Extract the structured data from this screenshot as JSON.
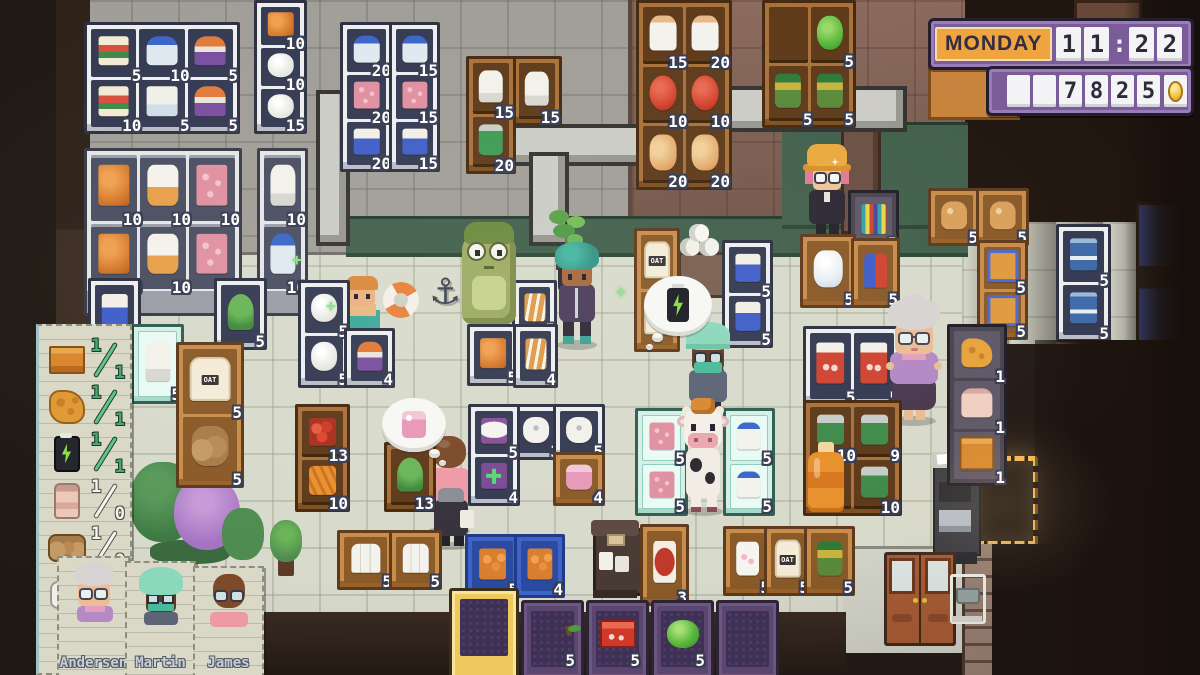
{
  "hud": {
    "day": "MONDAY",
    "time": "11:22",
    "money": "7825",
    "money_lead_blanks": 2,
    "colors": {
      "panel_purple": "#7a5c98",
      "day_orange": "#f0a440",
      "cell_white": "#f4f4f6",
      "coin_gold": "#f2c23c",
      "count_text": "#ffffff",
      "checklist_done_green": "#46a872",
      "hotbar_selected_gold": "#f0c95e"
    }
  },
  "checklist": {
    "items": [
      {
        "icon": "crate-icon",
        "have": "1",
        "need": "1",
        "done": true
      },
      {
        "icon": "cheese-icon",
        "have": "1",
        "need": "1",
        "done": true
      },
      {
        "icon": "battery-icon",
        "have": "1",
        "need": "1",
        "done": true
      },
      {
        "icon": "bottle-icon",
        "have": "1",
        "need": "0",
        "done": false
      },
      {
        "icon": "sack-icon",
        "have": "1",
        "need": "0",
        "done": false
      },
      {
        "icon": "paper-roll-icon",
        "have": "1",
        "need": "0",
        "done": false
      }
    ]
  },
  "staff_cards": [
    {
      "name": "Andersen"
    },
    {
      "name": "Martin"
    },
    {
      "name": "James"
    }
  ],
  "hotbar": {
    "slots": [
      {
        "item": "none",
        "count": "",
        "selected": true
      },
      {
        "item": "apple",
        "count": "5",
        "selected": false
      },
      {
        "item": "red-box",
        "count": "5",
        "selected": false
      },
      {
        "item": "lettuce",
        "count": "5",
        "selected": false
      },
      {
        "item": "none",
        "count": "",
        "selected": false
      }
    ]
  },
  "thought_bubbles": [
    {
      "id": "thought-bubble-battery",
      "icon": "battery-icon"
    },
    {
      "id": "thought-bubble-soap",
      "icon": "soap-icon"
    }
  ],
  "shelves": [
    {
      "id": "freezer-snacks-grid",
      "style": "frz",
      "x": 84,
      "y": 22,
      "w": 150,
      "h": 106,
      "cols": 3,
      "cells": [
        {
          "item": "snackbox",
          "count": "5"
        },
        {
          "item": "water",
          "count": "10"
        },
        {
          "item": "icepop",
          "count": "5"
        },
        {
          "item": "snackbox",
          "count": "10"
        },
        {
          "item": "milkcarton",
          "count": "5"
        },
        {
          "item": "icepop",
          "count": "5"
        }
      ]
    },
    {
      "id": "freezer-column-left",
      "style": "frz",
      "x": 254,
      "y": 0,
      "w": 47,
      "h": 128,
      "cols": 1,
      "cells": [
        {
          "item": "orangefood",
          "count": "10"
        },
        {
          "item": "chicken",
          "count": "10"
        },
        {
          "item": "chicken",
          "count": "15"
        }
      ]
    },
    {
      "id": "glass-freezer-triple",
      "style": "glass",
      "x": 84,
      "y": 148,
      "w": 152,
      "h": 162,
      "cols": 3,
      "cells": [
        {
          "item": "orangefood",
          "count": "10"
        },
        {
          "item": "breadbag",
          "count": "10"
        },
        {
          "item": "meatpink",
          "count": "10"
        },
        {
          "item": "orangefood",
          "count": "10"
        },
        {
          "item": "breadbag",
          "count": "10"
        },
        {
          "item": "meatpink",
          "count": "10"
        }
      ]
    },
    {
      "id": "glass-freezer-single",
      "style": "glass",
      "x": 257,
      "y": 148,
      "w": 45,
      "h": 162,
      "cols": 1,
      "cells": [
        {
          "item": "ricebag",
          "count": "10"
        },
        {
          "item": "water",
          "count": "10"
        }
      ]
    },
    {
      "id": "freezer-column-mid-1",
      "style": "frz",
      "x": 340,
      "y": 22,
      "w": 47,
      "h": 144,
      "cols": 1,
      "cells": [
        {
          "item": "water",
          "count": "20"
        },
        {
          "item": "meatpink",
          "count": "20"
        },
        {
          "item": "friesbox",
          "count": "20"
        }
      ]
    },
    {
      "id": "freezer-column-mid-2",
      "style": "frz",
      "x": 389,
      "y": 22,
      "w": 45,
      "h": 144,
      "cols": 1,
      "cells": [
        {
          "item": "water",
          "count": "15"
        },
        {
          "item": "meatpink",
          "count": "15"
        },
        {
          "item": "friesbox",
          "count": "15"
        }
      ]
    },
    {
      "id": "backroom-shelf-rice",
      "style": "wood",
      "x": 466,
      "y": 56,
      "w": 44,
      "h": 112,
      "cols": 1,
      "cells": [
        {
          "item": "ricebag",
          "count": "15"
        },
        {
          "item": "greencan",
          "count": "20"
        }
      ]
    },
    {
      "id": "backroom-shelf-rice-2",
      "style": "wood",
      "x": 512,
      "y": 56,
      "w": 44,
      "h": 64,
      "cols": 1,
      "cells": [
        {
          "item": "ricebag",
          "count": "15"
        }
      ]
    },
    {
      "id": "grocery-shelf-dairy",
      "style": "wood",
      "x": 636,
      "y": 0,
      "w": 90,
      "h": 184,
      "cols": 2,
      "cells": [
        {
          "item": "milkbottle",
          "count": "15"
        },
        {
          "item": "milkbottle",
          "count": "20"
        },
        {
          "item": "tomato",
          "count": "10"
        },
        {
          "item": "tomato",
          "count": "10"
        },
        {
          "item": "bun",
          "count": "20"
        },
        {
          "item": "bun",
          "count": "20"
        }
      ]
    },
    {
      "id": "grocery-shelf-veg",
      "style": "wood",
      "x": 762,
      "y": 0,
      "w": 88,
      "h": 122,
      "cols": 2,
      "cells": [
        {
          "item": "empty",
          "count": ""
        },
        {
          "item": "lettuce",
          "count": "5"
        },
        {
          "item": "pickles",
          "count": "5"
        },
        {
          "item": "pickles",
          "count": "5"
        }
      ]
    },
    {
      "id": "freezer-fries",
      "style": "frz",
      "x": 88,
      "y": 278,
      "w": 47,
      "h": 66,
      "cols": 1,
      "cells": [
        {
          "item": "friesbox",
          "count": "5"
        }
      ]
    },
    {
      "id": "fridge-small",
      "style": "mint",
      "x": 131,
      "y": 324,
      "w": 47,
      "h": 74,
      "cols": 1,
      "cells": [
        {
          "item": "ricebag",
          "count": "5"
        }
      ]
    },
    {
      "id": "oat-stand",
      "style": "stand",
      "x": 176,
      "y": 342,
      "w": 62,
      "h": 140,
      "cols": 1,
      "cells": [
        {
          "item": "oatbag",
          "count": "5",
          "label": "OAT"
        },
        {
          "item": "sack",
          "count": "5"
        }
      ]
    },
    {
      "id": "plant-display",
      "style": "frz",
      "x": 214,
      "y": 278,
      "w": 47,
      "h": 66,
      "cols": 1,
      "cells": [
        {
          "item": "plant",
          "count": "5"
        }
      ]
    },
    {
      "id": "freezer-chicken",
      "style": "frz",
      "x": 298,
      "y": 280,
      "w": 46,
      "h": 102,
      "cols": 1,
      "cells": [
        {
          "item": "chicken",
          "count": "5"
        },
        {
          "item": "chicken",
          "count": "5"
        }
      ]
    },
    {
      "id": "freezer-icepop",
      "style": "frz",
      "x": 344,
      "y": 328,
      "w": 45,
      "h": 54,
      "cols": 1,
      "cells": [
        {
          "item": "icepop",
          "count": "4"
        }
      ]
    },
    {
      "id": "fridge-croissant-1",
      "style": "frz",
      "x": 512,
      "y": 280,
      "w": 39,
      "h": 52,
      "cols": 1,
      "cells": [
        {
          "item": "croissant",
          "count": "5"
        }
      ]
    },
    {
      "id": "fridge-snack-orange",
      "style": "frz",
      "x": 467,
      "y": 324,
      "w": 46,
      "h": 56,
      "cols": 1,
      "cells": [
        {
          "item": "orangefood",
          "count": "5"
        }
      ]
    },
    {
      "id": "fridge-croissant-2",
      "style": "frz",
      "x": 513,
      "y": 324,
      "w": 39,
      "h": 58,
      "cols": 1,
      "cells": [
        {
          "item": "croissant",
          "count": "4"
        }
      ]
    },
    {
      "id": "shelf-oat-column",
      "style": "stand",
      "x": 634,
      "y": 228,
      "w": 40,
      "h": 118,
      "cols": 1,
      "cells": [
        {
          "item": "oatbag",
          "count": "5",
          "label": "OAT"
        },
        {
          "item": "oatbag",
          "count": "",
          "label": "OAT"
        }
      ]
    },
    {
      "id": "freezer-fries-column",
      "style": "frz",
      "x": 722,
      "y": 240,
      "w": 45,
      "h": 102,
      "cols": 1,
      "cells": [
        {
          "item": "friesbox",
          "count": "5"
        },
        {
          "item": "friesbox",
          "count": "5"
        }
      ]
    },
    {
      "id": "counter-water",
      "style": "stand",
      "x": 800,
      "y": 234,
      "w": 50,
      "h": 68,
      "cols": 1,
      "cells": [
        {
          "item": "waterjug",
          "count": "5"
        }
      ]
    },
    {
      "id": "rack-misc",
      "style": "dark",
      "x": 848,
      "y": 190,
      "w": 45,
      "h": 56,
      "cols": 1,
      "cells": [
        {
          "item": "umbrella",
          "count": "5"
        }
      ]
    },
    {
      "id": "display-jacket",
      "style": "stand",
      "x": 851,
      "y": 238,
      "w": 43,
      "h": 64,
      "cols": 1,
      "cells": [
        {
          "item": "jacket",
          "count": "5"
        }
      ]
    },
    {
      "id": "stand-bread-1",
      "style": "stand",
      "x": 928,
      "y": 188,
      "w": 46,
      "h": 52,
      "cols": 1,
      "cells": [
        {
          "item": "bread",
          "count": "5"
        }
      ]
    },
    {
      "id": "stand-bread-2",
      "style": "stand",
      "x": 976,
      "y": 188,
      "w": 47,
      "h": 52,
      "cols": 1,
      "cells": [
        {
          "item": "bread",
          "count": "5"
        }
      ]
    },
    {
      "id": "shelf-blue-boxes",
      "style": "stand",
      "x": 977,
      "y": 240,
      "w": 45,
      "h": 94,
      "cols": 1,
      "cells": [
        {
          "item": "bluebox",
          "count": "5"
        },
        {
          "item": "bluebox",
          "count": "5"
        }
      ]
    },
    {
      "id": "fridge-blue-right",
      "style": "frz",
      "x": 1056,
      "y": 224,
      "w": 49,
      "h": 112,
      "cols": 1,
      "cells": [
        {
          "item": "bluedoor",
          "count": "5"
        },
        {
          "item": "bluedoor",
          "count": "5"
        }
      ]
    },
    {
      "id": "fridge-red-boxes",
      "style": "frz",
      "x": 803,
      "y": 326,
      "w": 92,
      "h": 74,
      "cols": 2,
      "cells": [
        {
          "item": "redbox",
          "count": "5"
        },
        {
          "item": "redbox",
          "count": "5"
        }
      ]
    },
    {
      "id": "shelf-canned",
      "style": "wood",
      "x": 803,
      "y": 400,
      "w": 93,
      "h": 110,
      "cols": 2,
      "cells": [
        {
          "item": "cans",
          "count": "10"
        },
        {
          "item": "cans",
          "count": "9"
        },
        {
          "item": "juice",
          "count": ""
        },
        {
          "item": "cans",
          "count": "10"
        }
      ]
    },
    {
      "id": "shelf-restock",
      "style": "dark",
      "x": 947,
      "y": 324,
      "w": 54,
      "h": 156,
      "cols": 1,
      "cells": [
        {
          "item": "cheese",
          "count": "1"
        },
        {
          "item": "pinkbottle",
          "count": "1"
        },
        {
          "item": "cratebox",
          "count": "1"
        }
      ]
    },
    {
      "id": "freezer-mint-meat",
      "style": "mint",
      "x": 635,
      "y": 408,
      "w": 47,
      "h": 102,
      "cols": 1,
      "cells": [
        {
          "item": "meatpink",
          "count": "5"
        },
        {
          "item": "meatpink",
          "count": "5"
        }
      ]
    },
    {
      "id": "freezer-mint-milk",
      "style": "mint",
      "x": 723,
      "y": 408,
      "w": 46,
      "h": 102,
      "cols": 1,
      "cells": [
        {
          "item": "milkbottle2",
          "count": "5"
        },
        {
          "item": "milkbottle2",
          "count": "5"
        }
      ]
    },
    {
      "id": "shelf-produce",
      "style": "wood",
      "x": 295,
      "y": 404,
      "w": 49,
      "h": 102,
      "cols": 1,
      "cells": [
        {
          "item": "peppers",
          "count": "13"
        },
        {
          "item": "carrots",
          "count": "10"
        }
      ]
    },
    {
      "id": "shelf-plants",
      "style": "wood",
      "x": 384,
      "y": 442,
      "w": 46,
      "h": 64,
      "cols": 1,
      "cells": [
        {
          "item": "plant",
          "count": "13"
        }
      ]
    },
    {
      "id": "shelf-pharmacy",
      "style": "frz",
      "x": 468,
      "y": 404,
      "w": 46,
      "h": 96,
      "cols": 1,
      "cells": [
        {
          "item": "pads",
          "count": "5"
        },
        {
          "item": "firstaid",
          "count": "4"
        }
      ]
    },
    {
      "id": "shelf-tp-1",
      "style": "frz",
      "x": 510,
      "y": 404,
      "w": 46,
      "h": 50,
      "cols": 1,
      "cells": [
        {
          "item": "tproll",
          "count": "3"
        }
      ]
    },
    {
      "id": "shelf-tp-2",
      "style": "frz",
      "x": 553,
      "y": 404,
      "w": 46,
      "h": 50,
      "cols": 1,
      "cells": [
        {
          "item": "tproll",
          "count": "5"
        }
      ]
    },
    {
      "id": "shelf-soap",
      "style": "stand",
      "x": 553,
      "y": 452,
      "w": 46,
      "h": 48,
      "cols": 1,
      "cells": [
        {
          "item": "soap",
          "count": "4"
        }
      ]
    },
    {
      "id": "stand-milk-1",
      "style": "stand",
      "x": 337,
      "y": 530,
      "w": 51,
      "h": 54,
      "cols": 1,
      "cells": [
        {
          "item": "milktrio",
          "count": "5"
        }
      ]
    },
    {
      "id": "stand-milk-2",
      "style": "stand",
      "x": 389,
      "y": 530,
      "w": 47,
      "h": 54,
      "cols": 1,
      "cells": [
        {
          "item": "milktrio",
          "count": "5"
        }
      ]
    },
    {
      "id": "crate-oranges-1",
      "style": "crate",
      "x": 465,
      "y": 534,
      "w": 49,
      "h": 58,
      "cols": 1,
      "cells": [
        {
          "item": "orangecrate",
          "count": "5"
        }
      ]
    },
    {
      "id": "crate-oranges-2",
      "style": "crate",
      "x": 514,
      "y": 534,
      "w": 45,
      "h": 58,
      "cols": 1,
      "cells": [
        {
          "item": "orangecrate",
          "count": "4"
        }
      ]
    },
    {
      "id": "display-meat-bag",
      "style": "stand",
      "x": 640,
      "y": 524,
      "w": 43,
      "h": 76,
      "cols": 1,
      "cells": [
        {
          "item": "meatbag",
          "count": "3"
        }
      ]
    },
    {
      "id": "display-marshmallow",
      "style": "stand",
      "x": 723,
      "y": 526,
      "w": 43,
      "h": 64,
      "cols": 1,
      "cells": [
        {
          "item": "mallow",
          "count": "5"
        }
      ]
    },
    {
      "id": "display-oat-bag",
      "style": "stand",
      "x": 764,
      "y": 526,
      "w": 41,
      "h": 64,
      "cols": 1,
      "cells": [
        {
          "item": "oatbag",
          "count": "5",
          "label": "OAT"
        }
      ]
    },
    {
      "id": "display-pickle-jar",
      "style": "stand",
      "x": 804,
      "y": 526,
      "w": 45,
      "h": 64,
      "cols": 1,
      "cells": [
        {
          "item": "pickles",
          "count": "5"
        }
      ]
    }
  ]
}
